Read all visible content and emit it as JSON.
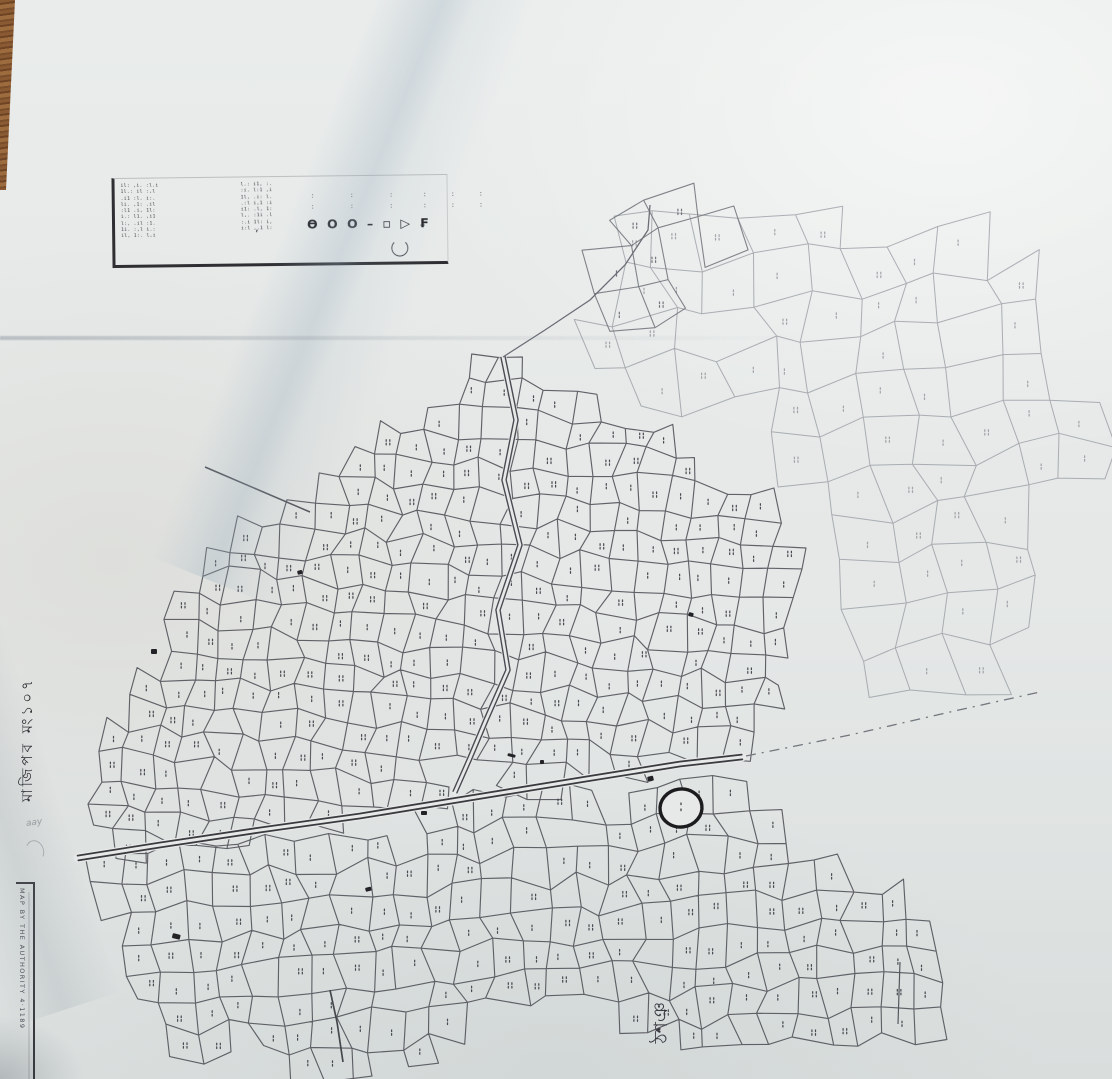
{
  "colors": {
    "paper": "#e6e9e8",
    "ink_dark": "#3a3a3f",
    "ink_parcel": "#55565c",
    "ink_faint": "#8f939a",
    "wood": "#8a5a33"
  },
  "stamp": {
    "left_rows": [
      "il: ,i. :l.i",
      "1l.: il :,l",
      ".i1 :l. i:.",
      "li. ,1: .il",
      ":l1 .i, 1l:",
      "i.: l1. ,i1",
      "l:, .il :1.",
      "1i. :,l i.:",
      "il, 1:. l,i"
    ],
    "mid_rows": [
      "l.: i1, :.",
      ":i. l:1 ,i",
      "1l, .i: l.",
      ".:l i,1 :i",
      "i1: .l, 1:",
      "l,. :1i .l",
      ":.i 1l: i,",
      "i:l ,.1 l:"
    ],
    "dot_rows": [
      ":      :      :     :    :    :",
      ":      :      :     :    :    :"
    ],
    "code": "Ɵ O O – ▫ ▷ ₣",
    "comma": ","
  },
  "labels": {
    "mouza_vertical": "মাজিপব মং১০৭",
    "village_bottom": "ঠশঞ",
    "authority": "MAP BY THE AUTHORITY  4·1189",
    "pencil_note": "aay"
  }
}
